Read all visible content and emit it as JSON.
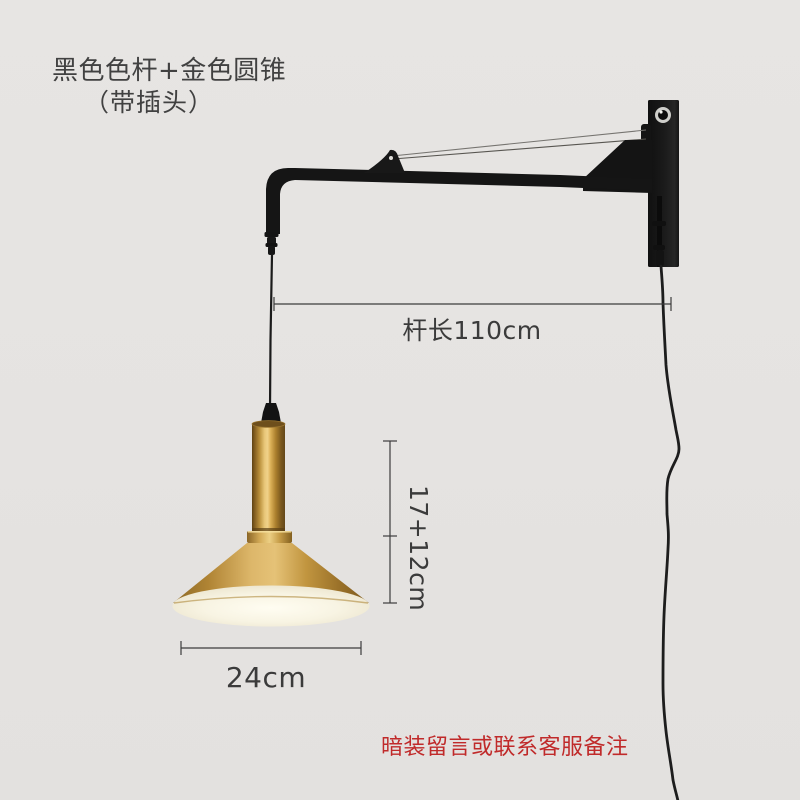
{
  "title": {
    "line1": "黑色色杆+金色圆锥",
    "line2": "（带插头）"
  },
  "annotations": {
    "arm_length": "杆长110cm",
    "pendant_height": "17+12cm",
    "shade_diameter": "24cm",
    "service_note": "暗装留言或联系客服备注"
  },
  "colors": {
    "background": "#e6e4e2",
    "title_text": "#414141",
    "annotation_text": "#3b3b3b",
    "note_red": "#c02a2a",
    "fixture_black": "#161616",
    "shade_gold": "#d9b264",
    "diffuser_cream": "#f6f2e3",
    "support_cable_gray": "#6b6964"
  },
  "fixture": {
    "description_parts": [
      "wall-mount-plate",
      "support-cable",
      "swing-arm",
      "pendant-cord",
      "gold-cylinder-socket",
      "gold-cone-shade",
      "diffuser",
      "power-cord-with-plug"
    ]
  }
}
